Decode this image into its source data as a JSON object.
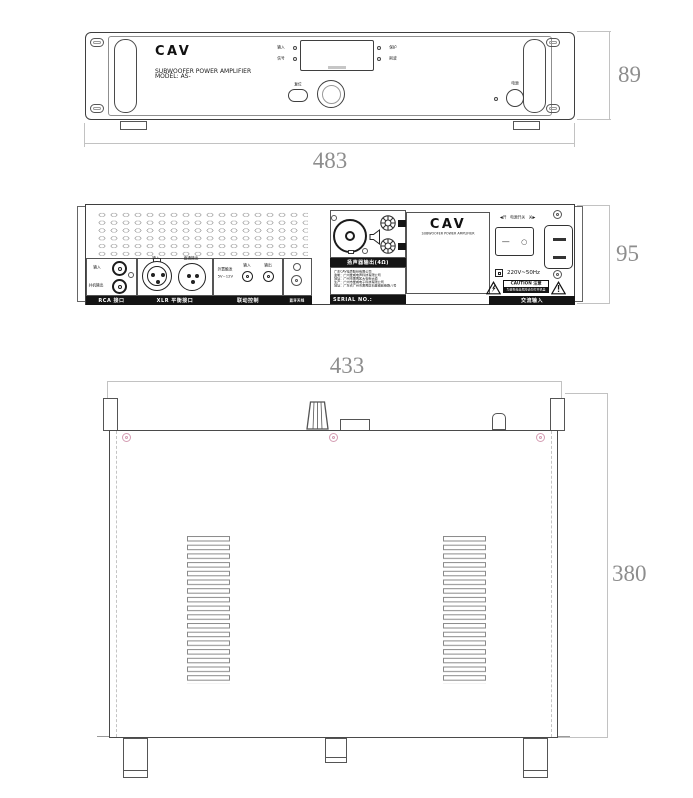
{
  "front": {
    "brand": "CAV",
    "brand_sub": "SUBWOOFER POWER AMPLIFIER",
    "model": "MODEL: AS-",
    "led_input": "输入",
    "led_signal": "信号",
    "led_protect": "保护",
    "led_clip": "削波",
    "reset_label": "复位",
    "power_label": "电源"
  },
  "rear": {
    "rca_title": "RCA 接口",
    "rca_in": "输入",
    "rca_out": "并机输出",
    "xlr_title": "XLR 平衡接口",
    "xlr_in": "输入",
    "xlr_out": "直通输出",
    "trig_title": "联动控制",
    "trig_line1": "外置触发",
    "trig_line2": "5V~12V",
    "trig_in": "输入",
    "trig_out": "输出",
    "ant_title": "蓝牙天线",
    "spk_title": "扬声器输出(4Ω)",
    "info_lines": [
      "广东CAV电声股份有限公司",
      "监制：广州爱威电声科技有限公司",
      "地址：广州市番禺区大石街大道",
      "生产：广州市爱威电子科技有限公司",
      "地址：广东省广州市番禺区石基镇前锋路八号"
    ],
    "serial_label": "SERIAL NO.:",
    "brand": "CAV",
    "brand_sub": "SUBWOOFER POWER AMPLIFIER",
    "switch_label": "◀开　电源开关　关▶",
    "switch_dash": "—",
    "switch_circle": "○",
    "voltage": "220V~50Hz",
    "caution_title": "CAUTION 注意",
    "caution_sub": "为避免电击危险请勿打开机盖",
    "ac_title": "交流输入"
  },
  "dims": {
    "front_width": "483",
    "front_height": "89",
    "rear_height": "95",
    "top_width": "433",
    "top_depth": "380"
  }
}
